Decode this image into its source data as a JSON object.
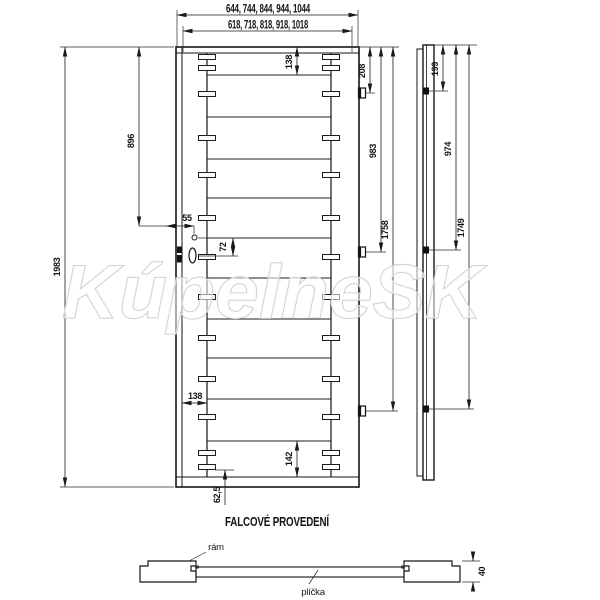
{
  "watermark": "KúpelneSK",
  "caption": "FALCOVÉ PROVEDENÍ",
  "labels": {
    "outer_widths": "644, 744, 844, 944, 1044",
    "leaf_widths": "618, 718, 818, 918, 1018",
    "door_height": "1983",
    "lock_height": "896",
    "lock_offset": "55",
    "handle_gap": "72",
    "top_rail": "138",
    "stile_width": "138",
    "bottom_rail": "142",
    "bottom_offset": "62,5",
    "hinge1_front": "208",
    "hinge2_front": "983",
    "hinge3_front": "1758",
    "hinge1_side": "199",
    "hinge2_side": "974",
    "hinge3_side": "1749",
    "thickness": "40",
    "frame_label": "rám",
    "panel_label": "plíčka"
  },
  "colors": {
    "door_face": "#e9e1d1",
    "section_stile": "#d2c1a3",
    "section_panel": "#dccdb2",
    "line": "#1a1a1a",
    "watermark_outline": "#c8c8c8"
  },
  "geometry": {
    "rail_y": [
      75,
      117,
      159,
      198,
      238,
      278,
      319,
      358,
      399,
      441
    ],
    "slot_y": [
      57,
      68,
      94,
      138,
      175,
      218,
      257,
      297,
      338,
      379,
      417,
      453,
      467
    ],
    "slot_x": [
      207,
      331
    ],
    "hinge_y_front": [
      93,
      252,
      411
    ],
    "hinge_y_side": [
      91,
      250,
      409
    ]
  }
}
